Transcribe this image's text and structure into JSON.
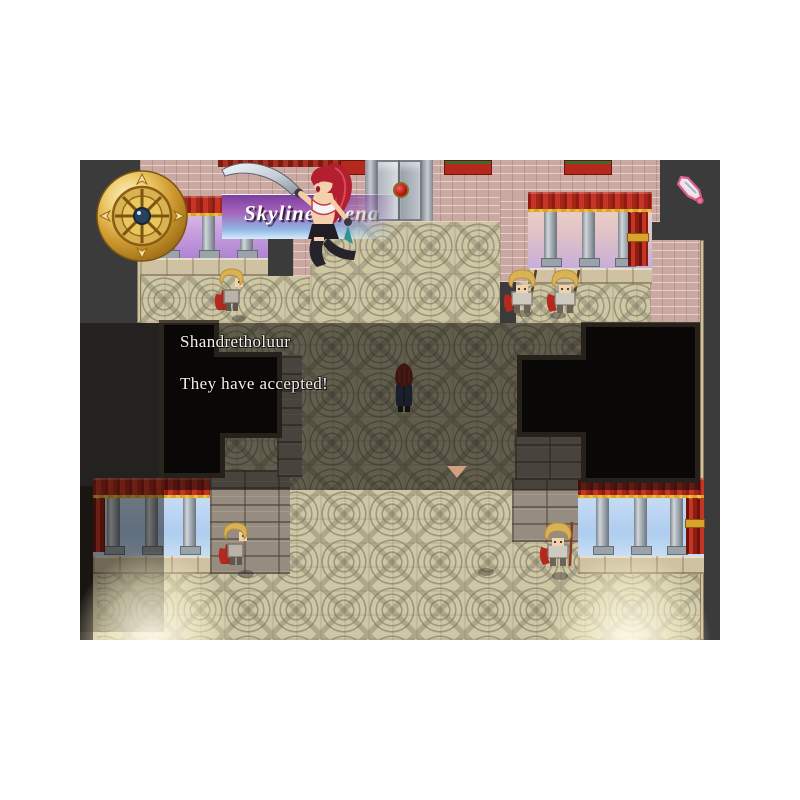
{
  "window": {
    "background_color": "#ffffff"
  },
  "game": {
    "viewport": {
      "width": 640,
      "height": 480,
      "void_color": "#3b3b3b"
    },
    "location_banner": {
      "text": "Skyline Arena",
      "text_color": "#ffffff",
      "gradient_top": "#7b3f9e",
      "gradient_bottom": "#d8ecf8",
      "emblem_icon": "compass-wheel-icon"
    },
    "dialogue": {
      "speaker": "Shandretholuur",
      "text": "They have accepted!",
      "text_color": "#f4f2ee",
      "window_tint": "rgba(10,8,5,0.55)",
      "continue_indicator_icon": "continue-arrow-icon"
    },
    "cursor": {
      "icon": "sword-cursor-icon",
      "color": "#e87098"
    },
    "characters": [
      {
        "name": "announcer-warrior-girl",
        "desc": "red-haired swordswoman artwork beside banner"
      },
      {
        "name": "player",
        "desc": "dark-red-haired hero in navy coat facing up, center"
      },
      {
        "name": "guard-upper-left",
        "desc": "blonde guard with red banner"
      },
      {
        "name": "guard-pair-upper-right",
        "desc": "two blonde guards with spears and red banners"
      },
      {
        "name": "guard-lower-left",
        "desc": "blonde guard with red cape"
      },
      {
        "name": "guard-lower-right",
        "desc": "blonde guard with spear and red banner"
      }
    ],
    "palette": {
      "floor": "#cfc7a4",
      "pink_wall": "#c9a9a2",
      "stone_wall": "#978c80",
      "curtain_red": "#c53526",
      "curtain_gold": "#d9a42c",
      "column": "#b9bfc5",
      "sky_purple": "#b794dc",
      "sky_sunset": "#e8c4ae",
      "sky_blue": "#aecdf0",
      "room_black": "#0b0a08",
      "gold_emblem": "#ecca6a"
    }
  }
}
